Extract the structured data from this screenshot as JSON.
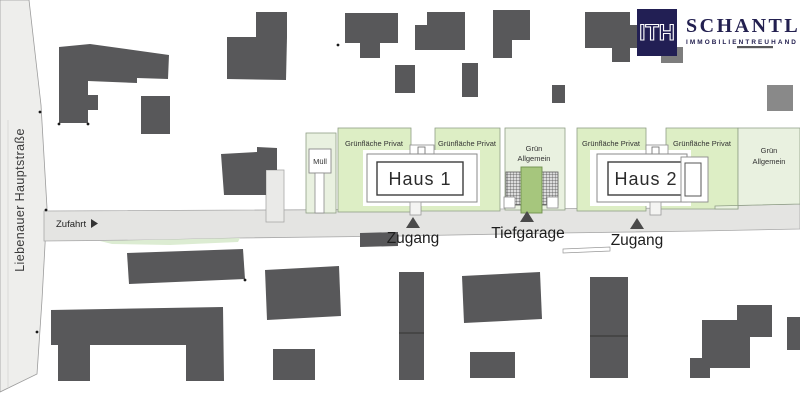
{
  "brand": {
    "mark": "ITH",
    "name": "SCHANTL",
    "subtitle": "IMMOBILIENTREUHAND"
  },
  "plan": {
    "street_name": "Liebenauer Hauptstraße",
    "access_label": "Zufahrt",
    "waste_label": "Müll",
    "private_green_label": "Grünfläche Privat",
    "common_green_line1": "Grün",
    "common_green_line2": "Allgemein",
    "house1_label": "Haus 1",
    "house2_label": "Haus 2",
    "entrance_label": "Zugang",
    "garage_label": "Tiefgarage"
  },
  "colors": {
    "building_gray": "#58585a",
    "private_green": "#ddeec5",
    "common_green": "#e9f1e0",
    "garage_ramp_green": "#a6c67d",
    "road_gray": "#e4e4e2",
    "street_gray": "#eeeeec",
    "brand_navy": "#221f54",
    "label_text": "#2e2e2e"
  }
}
